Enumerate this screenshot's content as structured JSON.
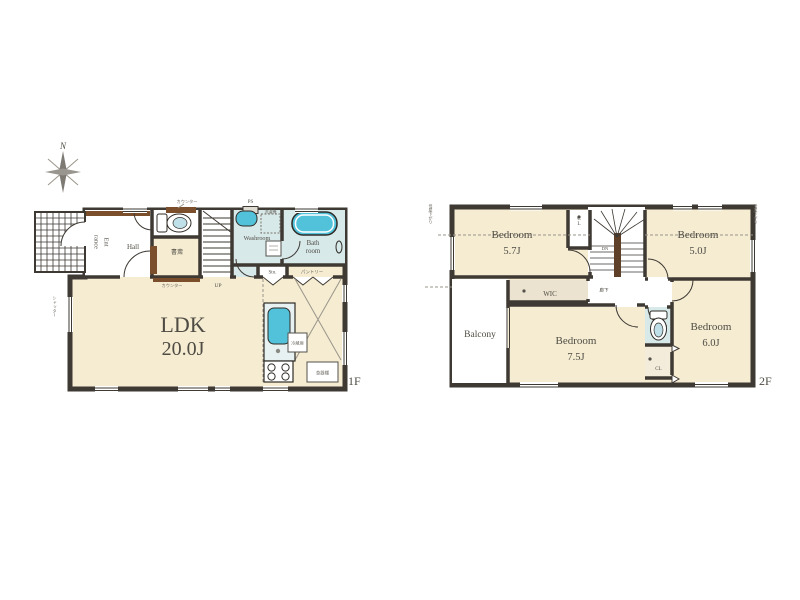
{
  "colors": {
    "wall": "#3e3933",
    "room_beige": "#f5ecd2",
    "water_blue": "#d8e9ea",
    "fixture_cyan": "#52c2da",
    "wood_brown": "#7b4f2c",
    "text": "#4f4c44"
  },
  "floor1": {
    "floor_label": "1F",
    "compass": "N",
    "ldk": {
      "name": "LDK",
      "size": "20.0J"
    },
    "entrance": {
      "line1": "Ent",
      "line2": "rance"
    },
    "hall": "Hall",
    "study": "書斎",
    "washroom": "Washroom",
    "bath": {
      "line1": "Bath",
      "line2": "room"
    },
    "storage": "Sto.",
    "pantry": "パントリー",
    "laundry": "洗濯機",
    "ps": "PS",
    "counter_top": "カウンター",
    "counter_bottom": "カウンター",
    "up": "UP",
    "shutter": "シャッター",
    "fridge": "冷蔵庫",
    "cupboard": "食器棚"
  },
  "floor2": {
    "floor_label": "2F",
    "bedroom_nw": {
      "name": "Bedroom",
      "size": "5.7J"
    },
    "bedroom_ne": {
      "name": "Bedroom",
      "size": "5.0J"
    },
    "bedroom_s": {
      "name": "Bedroom",
      "size": "7.5J"
    },
    "bedroom_se": {
      "name": "Bedroom",
      "size": "6.0J"
    },
    "closet_top": "CL",
    "closet_bottom": "CL",
    "wic": "WIC",
    "down": "DN",
    "hallway": "廊下",
    "balcony": "Balcony",
    "slope_left": "母屋下がり",
    "slope_right": "母屋下がり"
  }
}
